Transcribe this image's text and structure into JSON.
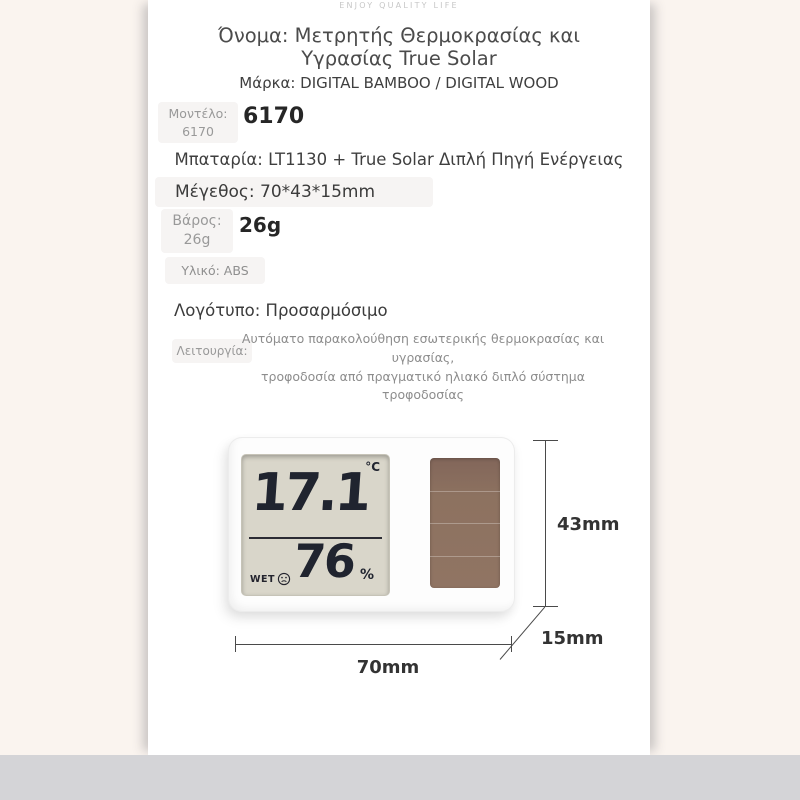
{
  "page": {
    "tagline": "ENJOY QUALITY LIFE"
  },
  "specs": {
    "title": "Όνομα: Μετρητής Θερμοκρασίας και Υγρασίας True Solar",
    "brand": "Μάρκα: DIGITAL BAMBOO / DIGITAL WOOD",
    "model_label": "Μοντέλο:",
    "model_label_value": "6170",
    "model_value": "6170",
    "battery": "Μπαταρία: LT1130 + True Solar Διπλή Πηγή Ενέργειας",
    "size": "Μέγεθος: 70*43*15mm",
    "weight_label": "Βάρος:",
    "weight_label_value": "26g",
    "weight_value": "26g",
    "material": "Υλικό: ABS",
    "logo": "Λογότυπο: Προσαρμόσιμο",
    "function_label": "Λειτουργία:",
    "function_line1": "Αυτόματο παρακολούθηση εσωτερικής θερμοκρασίας και υγρασίας,",
    "function_line2": "τροφοδοσία από πραγματικό ηλιακό διπλό σύστημα τροφοδοσίας"
  },
  "device": {
    "temperature": "17.1",
    "temperature_unit": "°C",
    "humidity": "76",
    "humidity_unit": "%",
    "wet_label": "WET",
    "lcd_bg": "#d9d6ca",
    "digit_color": "#20242f",
    "solar_color": "#8d7260"
  },
  "dimensions": {
    "height_mm": "43mm",
    "depth_mm": "15mm",
    "width_mm": "70mm"
  },
  "colors": {
    "page_bg": "#faf4ef",
    "panel_bg": "#ffffff",
    "footer_bar": "#d4d4d7",
    "label_gray": "#9a9a9a",
    "text_dark": "#3d3d3d"
  }
}
